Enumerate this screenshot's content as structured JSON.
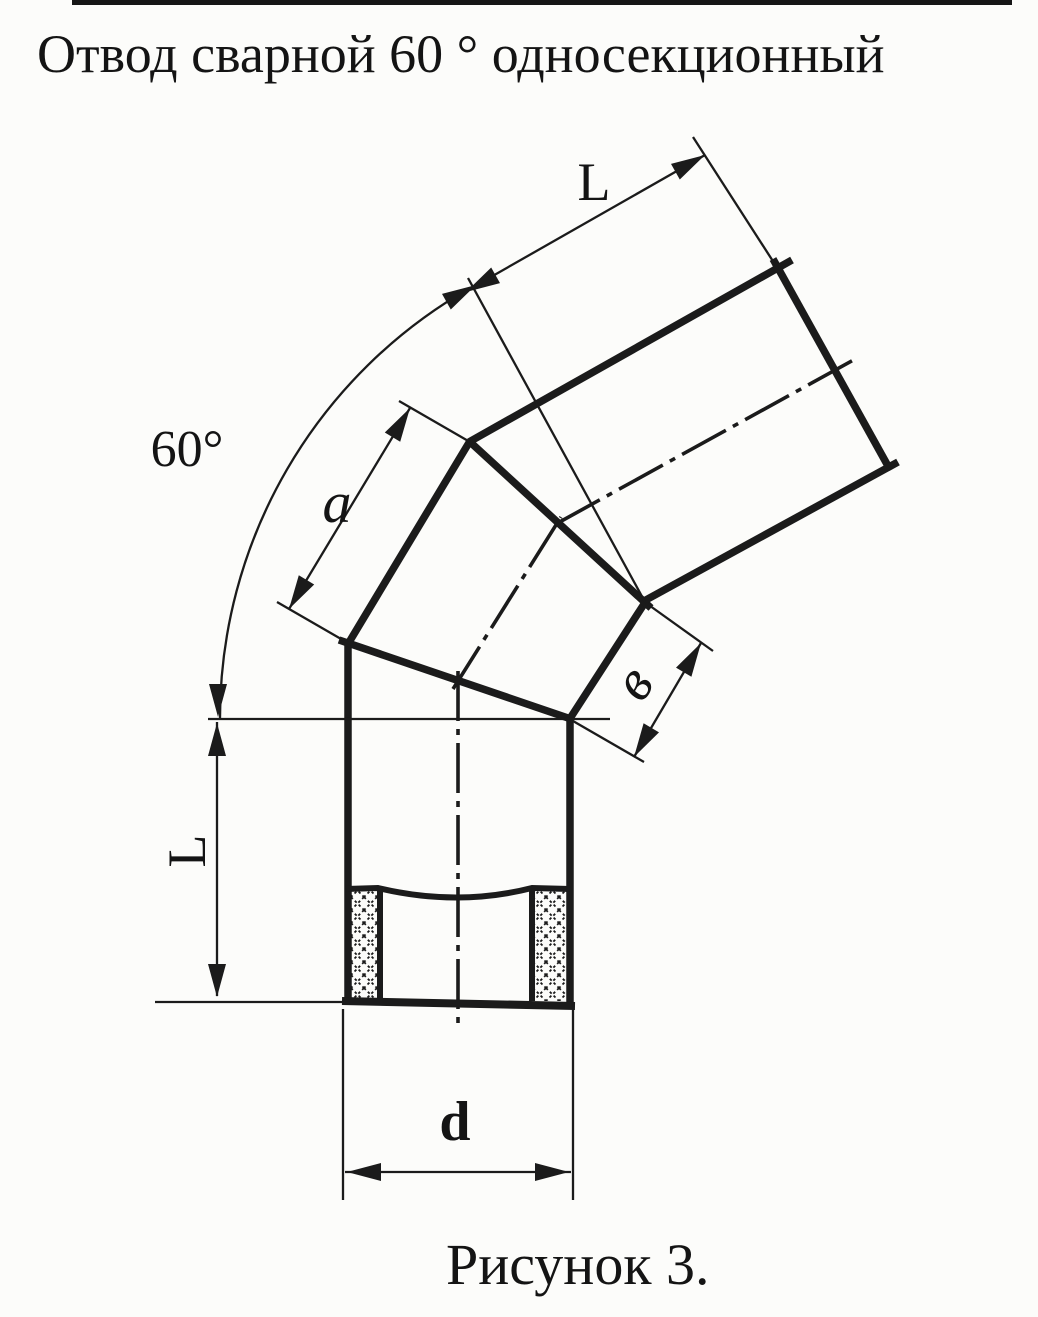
{
  "page": {
    "title": "Отвод сварной 60 ° односекционный",
    "caption": "Рисунок 3.",
    "colors": {
      "paper": "#fcfcfa",
      "ink": "#1b1b1b"
    }
  },
  "drawing": {
    "type": "technical-drawing",
    "labels": {
      "elbow_angle": "60°",
      "top_pipe_length": "L",
      "segment_long_side": "a",
      "segment_short_side": "в",
      "bottom_pipe_length": "L",
      "pipe_diameter": "d"
    }
  }
}
